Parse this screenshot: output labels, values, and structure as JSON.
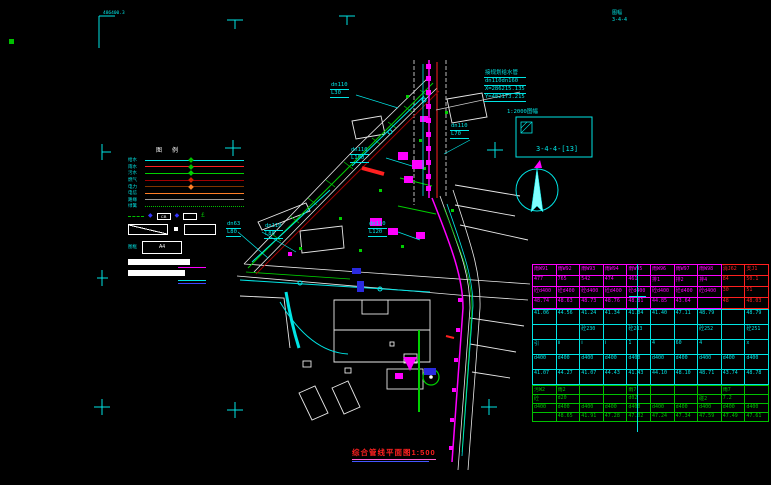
{
  "colors": {
    "cyan": "#00e5e5",
    "magenta": "#ff00ff",
    "red": "#ff2020",
    "green": "#00c000",
    "white": "#e8e8e8"
  },
  "corner_marks": {
    "tl_text": "486400.3",
    "tr_line1": "图幅",
    "tr_line2": "3-4-4"
  },
  "index_box": {
    "caption": "1:2000图幅",
    "code": "3-4-4-[13]"
  },
  "title": {
    "text": "综合管线平面图1:500"
  },
  "legend": {
    "header_col1": "图",
    "header_col2": "例",
    "rows": [
      {
        "label": "给水",
        "color": "#00e5e5",
        "marker": "#00c000",
        "dotted": false
      },
      {
        "label": "雨水",
        "color": "#ff2020",
        "marker": "#00c000",
        "dotted": false
      },
      {
        "label": "污水",
        "color": "#00d000",
        "marker": "#00d000",
        "dotted": false
      },
      {
        "label": "燃气",
        "color": "#a00000",
        "marker": "#cc2200",
        "dotted": false
      },
      {
        "label": "电力",
        "color": "#803300",
        "marker": "#ff7f27",
        "dotted": false
      },
      {
        "label": "电信",
        "color": "#ff7f27",
        "marker": "",
        "dotted": false
      },
      {
        "label": "路缘",
        "color": "#9a9a9a",
        "marker": "",
        "dotted": false
      },
      {
        "label": "绿篱",
        "color": "#00c000",
        "marker": "",
        "dotted": true
      }
    ],
    "symbol_box1": "CB",
    "symbol_box2": "",
    "symbol_glyph": "£",
    "frame_label": "图框",
    "a4_label": "A4"
  },
  "annotations": [
    {
      "x": 330,
      "y": 82,
      "color": "#00e5e5",
      "lines": [
        "dn110",
        "L30"
      ]
    },
    {
      "x": 484,
      "y": 70,
      "color": "#00e5e5",
      "lines": [
        "接规划给水管",
        "dn110dn160",
        "X=286215.135",
        "Y=482173.215"
      ]
    },
    {
      "x": 450,
      "y": 123,
      "color": "#00e5e5",
      "lines": [
        "dn110",
        "L70"
      ]
    },
    {
      "x": 350,
      "y": 147,
      "color": "#00e5e5",
      "lines": [
        "dn110",
        "L190"
      ]
    },
    {
      "x": 226,
      "y": 221,
      "color": "#00e5e5",
      "lines": [
        "dn63",
        "L80"
      ]
    },
    {
      "x": 264,
      "y": 223,
      "color": "#00e5e5",
      "lines": [
        "dn110",
        "L80"
      ]
    },
    {
      "x": 368,
      "y": 221,
      "color": "#00e5e5",
      "lines": [
        "dn110",
        "L120"
      ]
    }
  ],
  "table": {
    "sections": [
      {
        "name": "magenta",
        "color": "#ff00ff",
        "rh": "10px",
        "red_cols": [
          8,
          9
        ],
        "rows": [
          [
            "雨W91",
            "雨W92",
            "雨W93",
            "雨W94",
            "雨W95",
            "雨W96",
            "雨W97",
            "雨W98",
            "消J62",
            "支J1"
          ],
          [
            "477",
            "765",
            "542",
            "474",
            "461",
            "排1",
            "排2",
            "排4",
            "84",
            "50.1"
          ],
          [
            "砼d400",
            "砼d400",
            "砼d400",
            "砼d400",
            "砼d400",
            "砼d400",
            "砼d400",
            "砼d400",
            "30",
            "51"
          ],
          [
            "48.74",
            "48.63",
            "48.73",
            "48.76",
            "48.81",
            "44.85",
            "43.64",
            "",
            "48",
            "48.03"
          ]
        ]
      },
      {
        "name": "cyan",
        "color": "#00e5e5",
        "rh": "14px",
        "red_cols": [],
        "rows": [
          [
            "41.06",
            "44.56",
            "41.24",
            "41.34",
            "41.04",
            "41.40",
            "47.11",
            "48.79",
            "",
            "48.79"
          ],
          [
            "",
            "",
            "砼230",
            "",
            "砼283",
            "",
            "",
            "砼252",
            "",
            "砼251"
          ],
          [
            "引",
            "Ⅱ",
            "Ⅰ",
            "Ⅰ",
            "1",
            "4",
            "60",
            "4",
            "",
            "x"
          ],
          [
            "d400",
            "d400",
            "d400",
            "d400",
            "d400",
            "d400",
            "d400",
            "d400",
            "d400",
            "d400"
          ],
          [
            "41.07",
            "44.27",
            "41.07",
            "44.43",
            "41.43",
            "44.10",
            "48.10",
            "48.71",
            "43.74",
            "48.78"
          ]
        ]
      },
      {
        "name": "green",
        "color": "#00c000",
        "rh": "8px",
        "red_cols": [],
        "rows": [
          [
            "污W2",
            "雨2",
            "",
            "",
            "雨7",
            "",
            "",
            "",
            "雨7",
            ""
          ],
          [
            "砼",
            "d20",
            "",
            "",
            "d02",
            "",
            "",
            "碰2",
            "7.2",
            ""
          ],
          [
            "d400",
            "d400",
            "d400",
            "d400",
            "d400",
            "d400",
            "d400",
            "d400",
            "d400",
            "d400"
          ],
          [
            "",
            "48.65",
            "41.91",
            "47.28",
            "47.02",
            "47.24",
            "47.34",
            "47.59",
            "47.49",
            "47.61"
          ]
        ]
      }
    ]
  }
}
